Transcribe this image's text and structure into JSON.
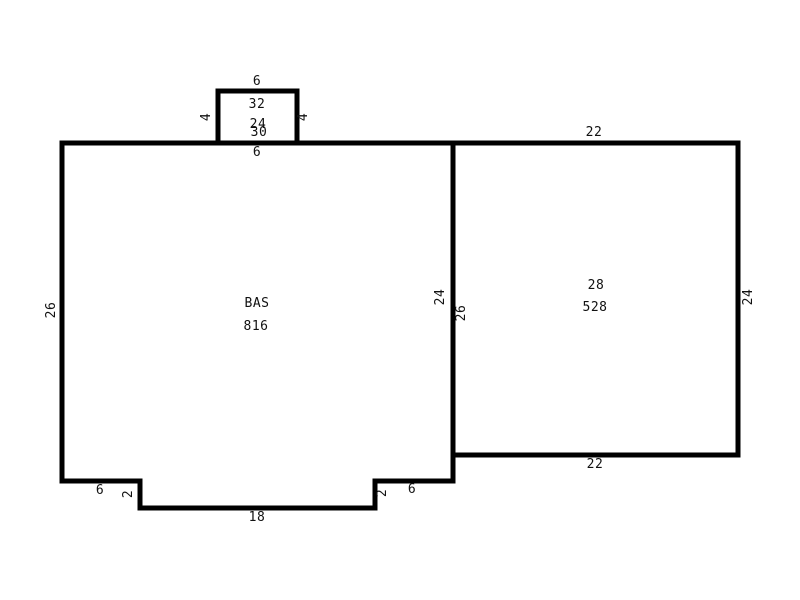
{
  "app": {
    "background_color": "#ffffff",
    "line_color": "#000000",
    "text_color": "#111111"
  },
  "sketch": {
    "areas": {
      "main": {
        "name": "BAS",
        "area": "816"
      },
      "right": {
        "name": "28",
        "area": "528"
      },
      "porch": {
        "name": "32",
        "area": "24"
      }
    },
    "dimensions": {
      "porch_top": "6",
      "porch_left": "4",
      "porch_right": "4",
      "main_top": "30",
      "main_top_segment": "6",
      "main_left": "26",
      "divider_left": "24",
      "divider_right": "26",
      "right_top": "22",
      "right_right": "24",
      "right_bottom": "22",
      "bottom_left_segment": "6",
      "bottom_left_step": "2",
      "bottom_center": "18",
      "bottom_right_step": "2",
      "bottom_right_segment": "6"
    }
  }
}
